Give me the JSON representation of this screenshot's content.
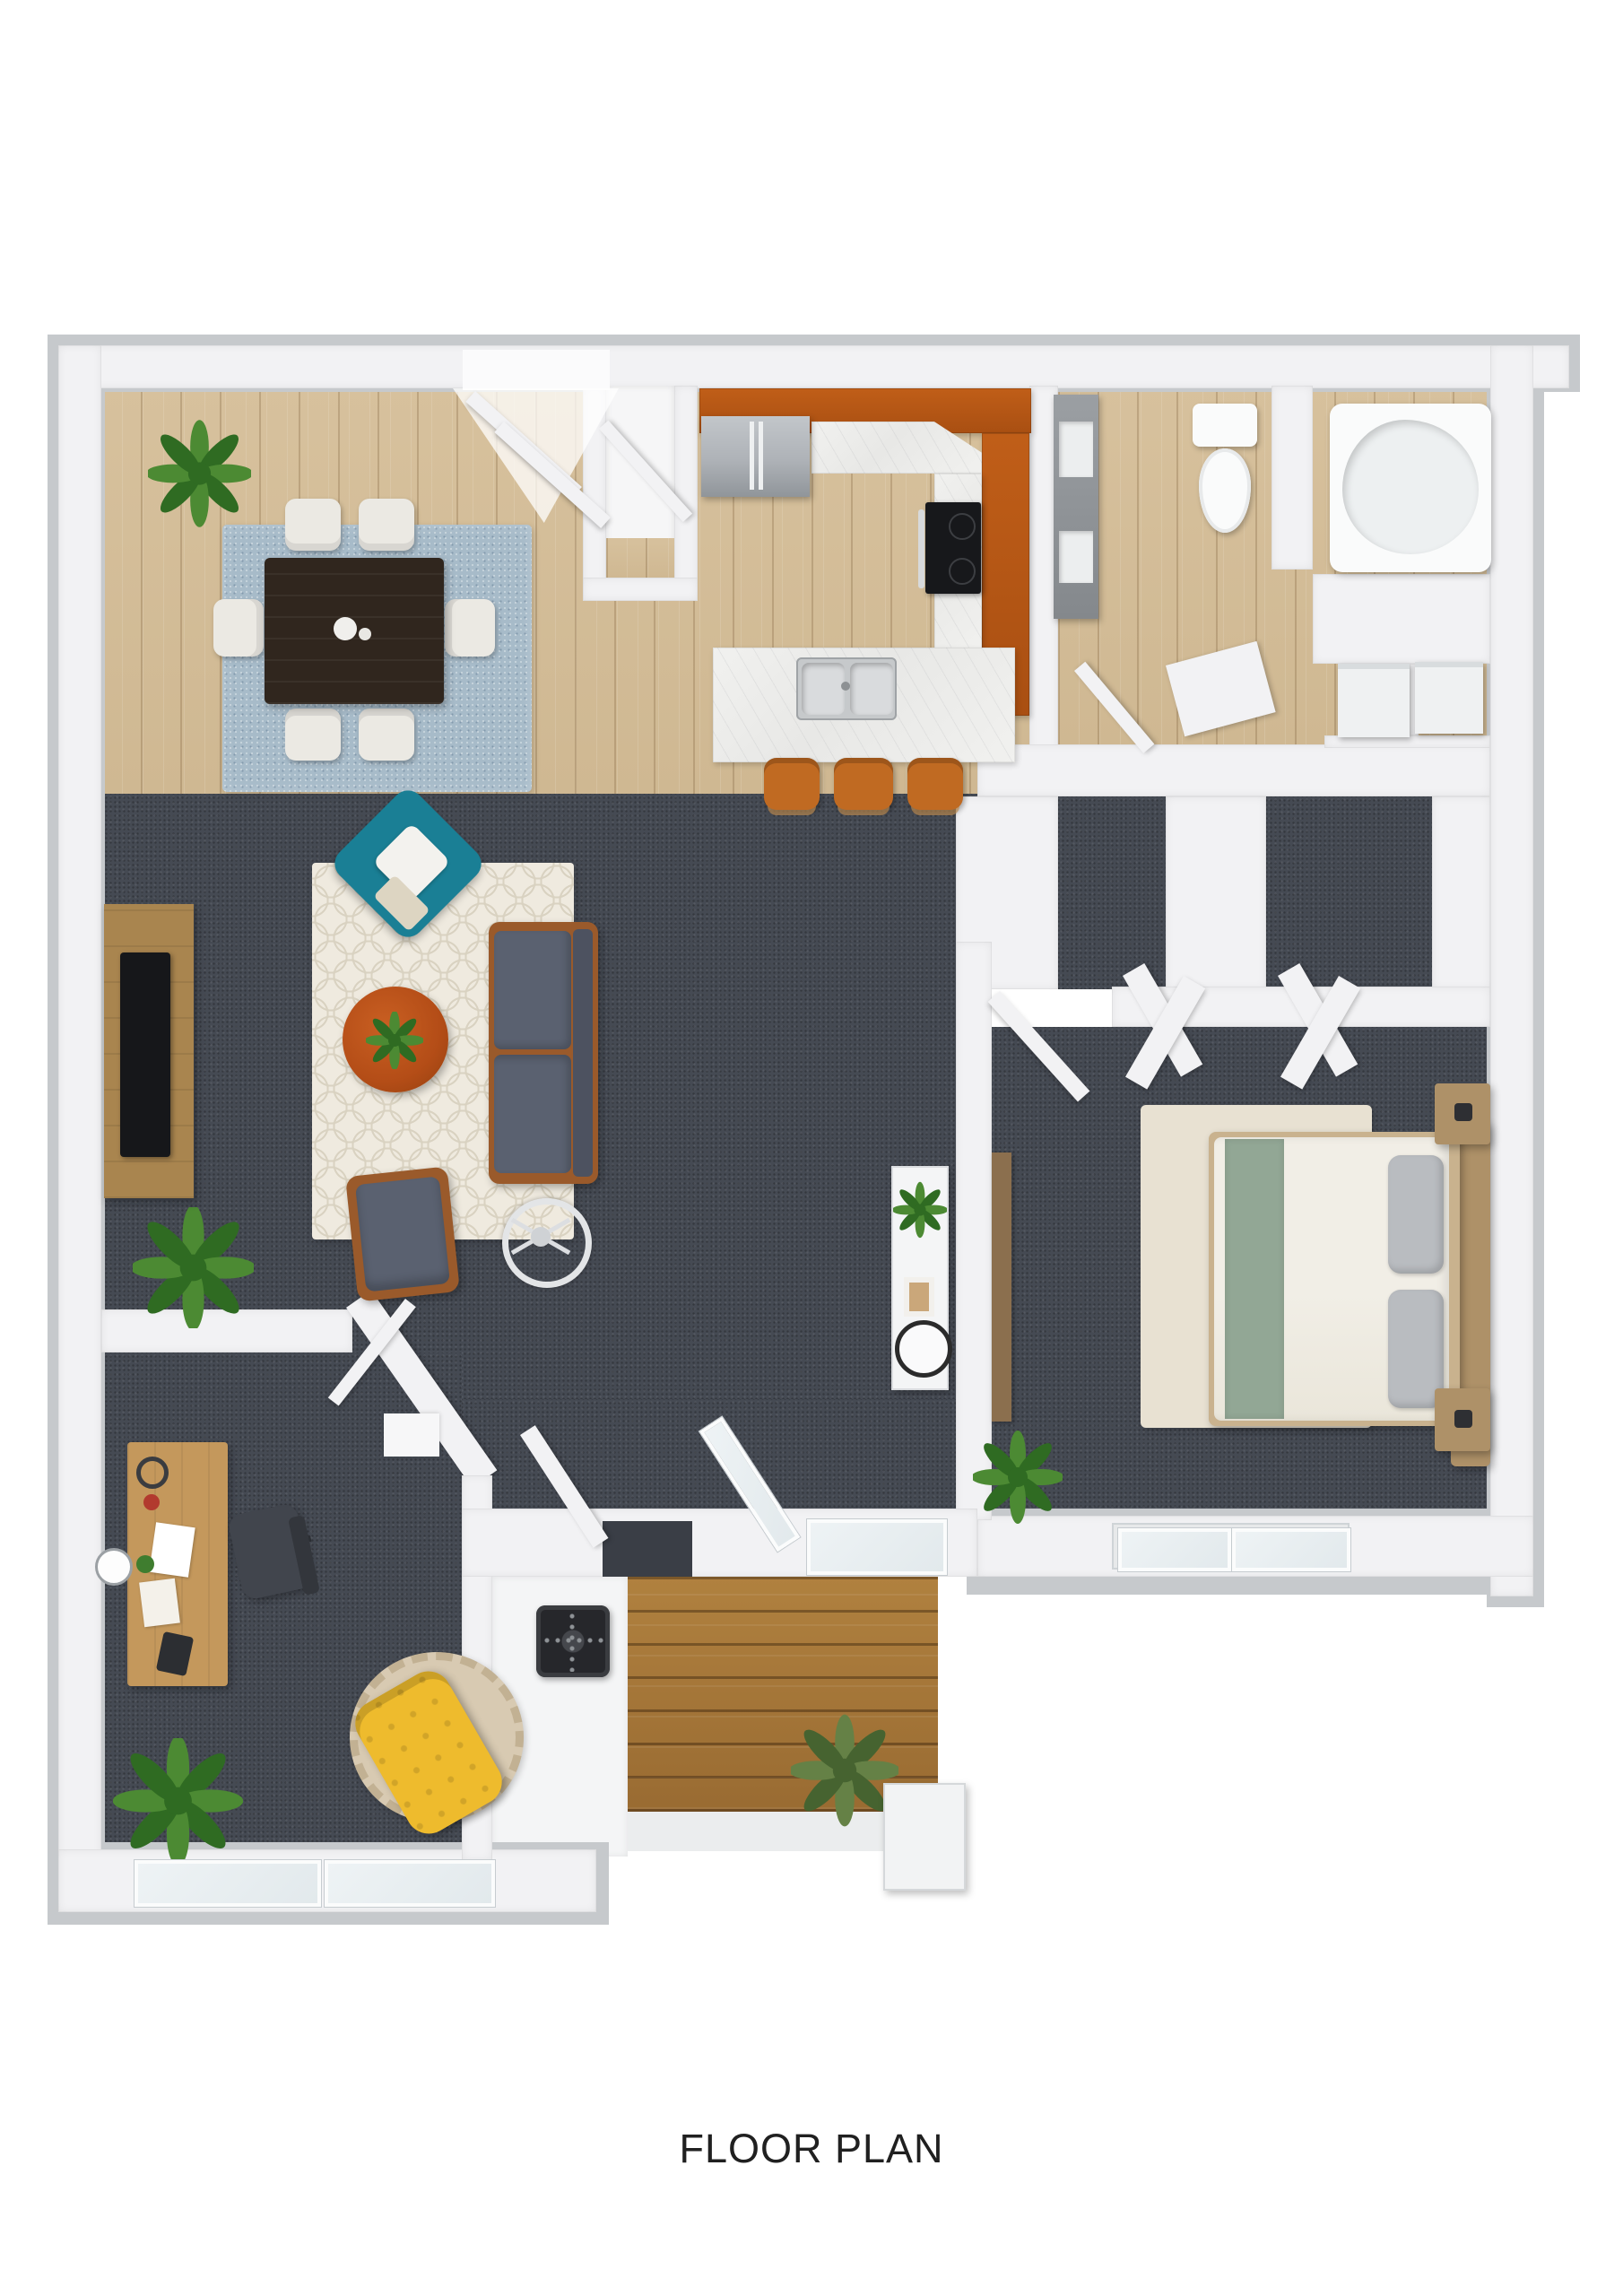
{
  "title": {
    "text": "FLOOR PLAN"
  },
  "colors": {
    "wall": "#f2f2f4",
    "outer": "#c6c9cc",
    "carpet": "#454a53",
    "woodA": "#d7c19d",
    "woodB": "#cfb892",
    "deckA": "#b0813f",
    "deckB": "#996b32",
    "cabinet": "#c05e18",
    "counterA": "#f1f1ef",
    "steel": "#aeb2b7",
    "sofa": "#5a6170",
    "sofaBack": "#4d5260",
    "teal": "#1a7f95",
    "coffee": "#b44d17",
    "rugLiving": "#efeadf",
    "rugLivingPat": "#d9d2c1",
    "rugDining": "#a7bbc9",
    "diningTable": "#30261e",
    "chair": "#ebe9e3",
    "stool": "#c06a22",
    "duvet": "#f1eee6",
    "bedGreen": "#92a795",
    "pillow": "#b9bcc0",
    "headboard": "#ae9168",
    "rugBed": "#e8e1d2",
    "yellow": "#eebb2d",
    "desk": "#c4985c",
    "officeChair": "#41454d",
    "rugOffice": "#d8cab2",
    "grill": "#26272b",
    "glassTint": "#eef3f5",
    "plantA": "#4c8a33",
    "plantB": "#2f6b22",
    "text": "#202020"
  },
  "scene": {
    "type": "3d-floor-plan-top-view",
    "rooms": [
      {
        "name": "dining-area",
        "items": [
          "dining-table",
          "dining-chairs-x6",
          "blue-area-rug",
          "potted-plant"
        ]
      },
      {
        "name": "kitchen",
        "items": [
          "refrigerator",
          "u-shaped-counter",
          "upper-cabinets-orange",
          "cooktop-stove",
          "double-sink",
          "breakfast-bar",
          "bar-stools-x3"
        ]
      },
      {
        "name": "entry",
        "items": [
          "double-entry-door-open",
          "entry-closet"
        ]
      },
      {
        "name": "bathroom",
        "items": [
          "toilet",
          "bathtub",
          "storage-tower",
          "utility-closet",
          "appliances-x2",
          "open-doors"
        ]
      },
      {
        "name": "living-room",
        "items": [
          "sofa",
          "teal-accent-chair",
          "gray-armchair",
          "round-coffee-table",
          "trellis-rug",
          "tv-console",
          "tv",
          "tripod-floor-lamp",
          "palm-plant",
          "console-table",
          "round-mirror"
        ]
      },
      {
        "name": "bedroom",
        "items": [
          "double-bed",
          "green-runner",
          "pillows-x2",
          "headboard",
          "nightstands-x2",
          "beige-rug",
          "closet-door-panels",
          "entry-door",
          "potted-plant",
          "double-window",
          "dresser"
        ]
      },
      {
        "name": "office",
        "items": [
          "desk-with-clutter",
          "office-chair",
          "yellow-tufted-chair",
          "round-rug",
          "wall-clock",
          "palm-plant",
          "window-wall"
        ]
      },
      {
        "name": "patio-deck",
        "items": [
          "wood-deck",
          "grill",
          "potted-plant",
          "white-step",
          "sliding-glass-door-open",
          "white-patio-door"
        ]
      }
    ]
  }
}
